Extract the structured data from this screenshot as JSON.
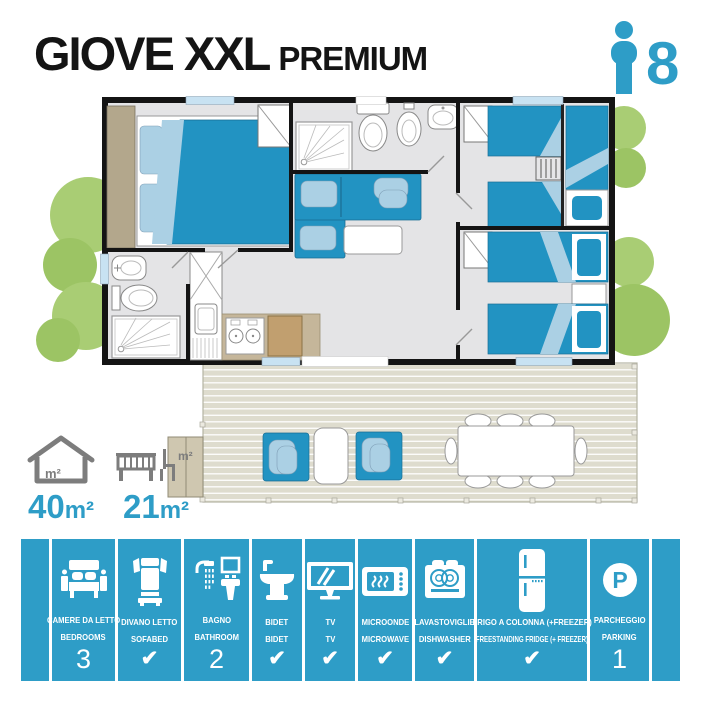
{
  "header": {
    "title": "GIOVE XXL",
    "title_suffix": "PREMIUM",
    "capacity": "8"
  },
  "areas": {
    "interior": {
      "value": "40",
      "unit": "m²"
    },
    "terrace": {
      "value": "21",
      "unit": "m²"
    }
  },
  "amenities": [
    {
      "icon": "double-bed-icon",
      "label_it": "CAMERE DA LETTO",
      "label_en": "BEDROOMS",
      "value": "3"
    },
    {
      "icon": "sofabed-icon",
      "label_it": "DIVANO LETTO",
      "label_en": "SOFABED",
      "value": "✔"
    },
    {
      "icon": "bathroom-icon",
      "label_it": "BAGNO",
      "label_en": "BATHROOM",
      "value": "2"
    },
    {
      "icon": "bidet-icon",
      "label_it": "BIDET",
      "label_en": "BIDET",
      "value": "✔"
    },
    {
      "icon": "tv-icon",
      "label_it": "TV",
      "label_en": "TV",
      "value": "✔"
    },
    {
      "icon": "microwave-icon",
      "label_it": "MICROONDE",
      "label_en": "MICROWAVE",
      "value": "✔"
    },
    {
      "icon": "dishwasher-icon",
      "label_it": "LAVASTOVIGLIE",
      "label_en": "DISHWASHER",
      "value": "✔"
    },
    {
      "icon": "fridge-icon",
      "label_it": "FRIGO A COLONNA (+FREEZER)",
      "label_en": "FREESTANDING FRIDGE (+ FREEZER)",
      "value": "✔"
    },
    {
      "icon": "parking-icon",
      "label_it": "PARCHEGGIO",
      "label_en": "PARKING",
      "value": "1",
      "icon_letter": "P"
    }
  ],
  "colors": {
    "brand_blue": "#2E9DC7",
    "furniture_blue": "#2293C2",
    "light_blue": "#ABD0E4",
    "window_blue": "#C8E2F2",
    "floor_gray": "#E4E4E6",
    "wall_black": "#141414",
    "wardrobe_tan": "#B3A78C",
    "counter_tan": "#C5B69A",
    "cabinet_brown": "#C19F6F",
    "deck_beige": "#DEDCCE",
    "tree_green": "#A9CD74",
    "tree_green_alt": "#9CC464",
    "icon_gray": "#7D7D7D",
    "text_black": "#141414"
  }
}
